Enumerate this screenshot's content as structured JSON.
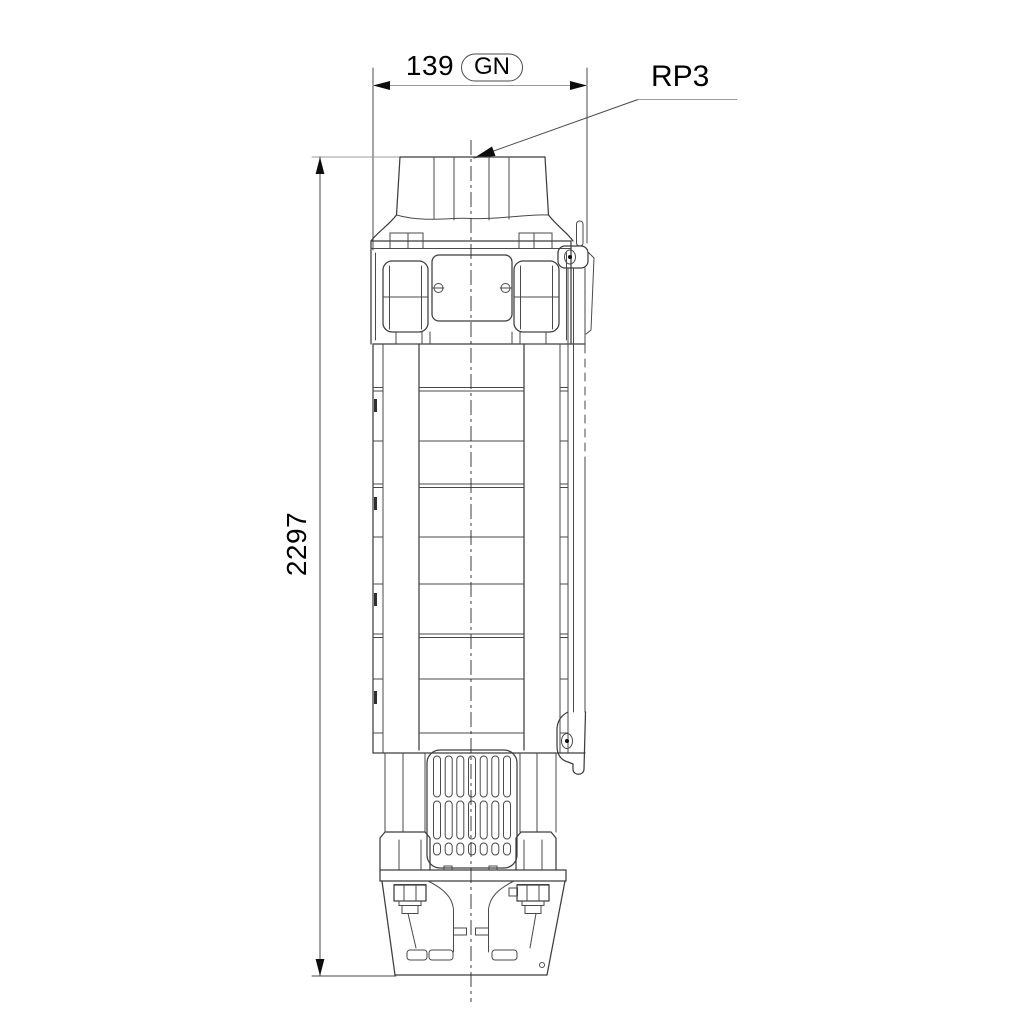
{
  "dimensions": {
    "width": {
      "value": "139",
      "thread_note": "GN"
    },
    "height": {
      "value": "2297"
    }
  },
  "labels": {
    "connection": "RP3"
  },
  "colors": {
    "outline": "#3d3d3d",
    "light_line": "#9b9b9b",
    "text": "#000000",
    "arrow": "#0d0d0d",
    "background": "#ffffff"
  }
}
